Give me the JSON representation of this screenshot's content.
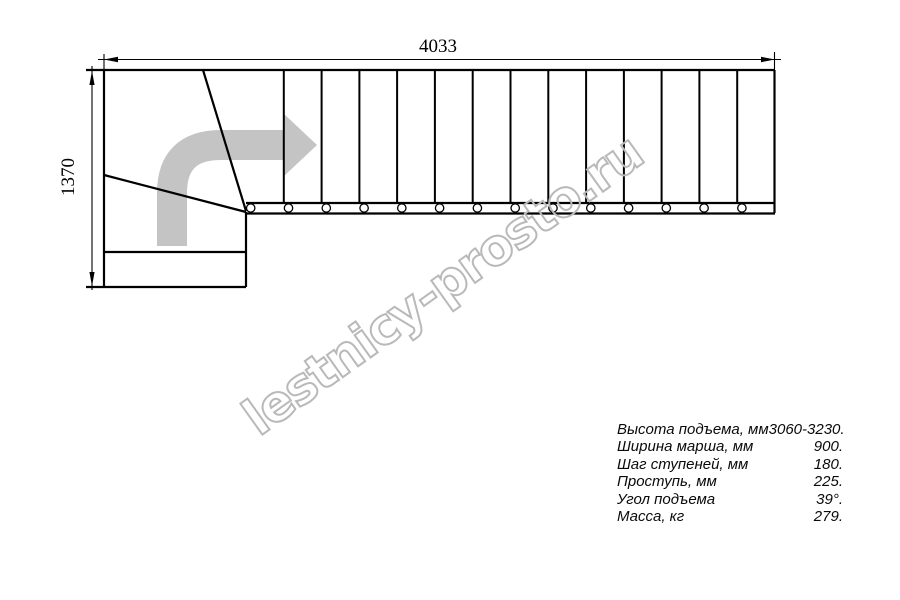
{
  "drawing": {
    "type": "staircase-plan",
    "dimensions": {
      "width_label": "4033",
      "height_label": "1370"
    },
    "stairs": {
      "tread_count": 14,
      "bolt_count": 14,
      "winder_steps": 3,
      "direction_arrow": "up-then-right-turn"
    },
    "colors": {
      "line": "#000000",
      "arrow": "#c4c4c4",
      "watermark": "#b9b9b9",
      "background": "#ffffff"
    }
  },
  "watermark": {
    "text": "lestnicy-prosto.ru"
  },
  "specs": {
    "rows": [
      {
        "label": "Высота подъема, мм",
        "value": "3060-3230."
      },
      {
        "label": "Ширина марша, мм",
        "value": "900."
      },
      {
        "label": "Шаг ступеней, мм",
        "value": "180."
      },
      {
        "label": "Проступь, мм",
        "value": "225."
      },
      {
        "label": "Угол подъема",
        "value": "39°."
      },
      {
        "label": "Масса, кг",
        "value": "279."
      }
    ]
  }
}
